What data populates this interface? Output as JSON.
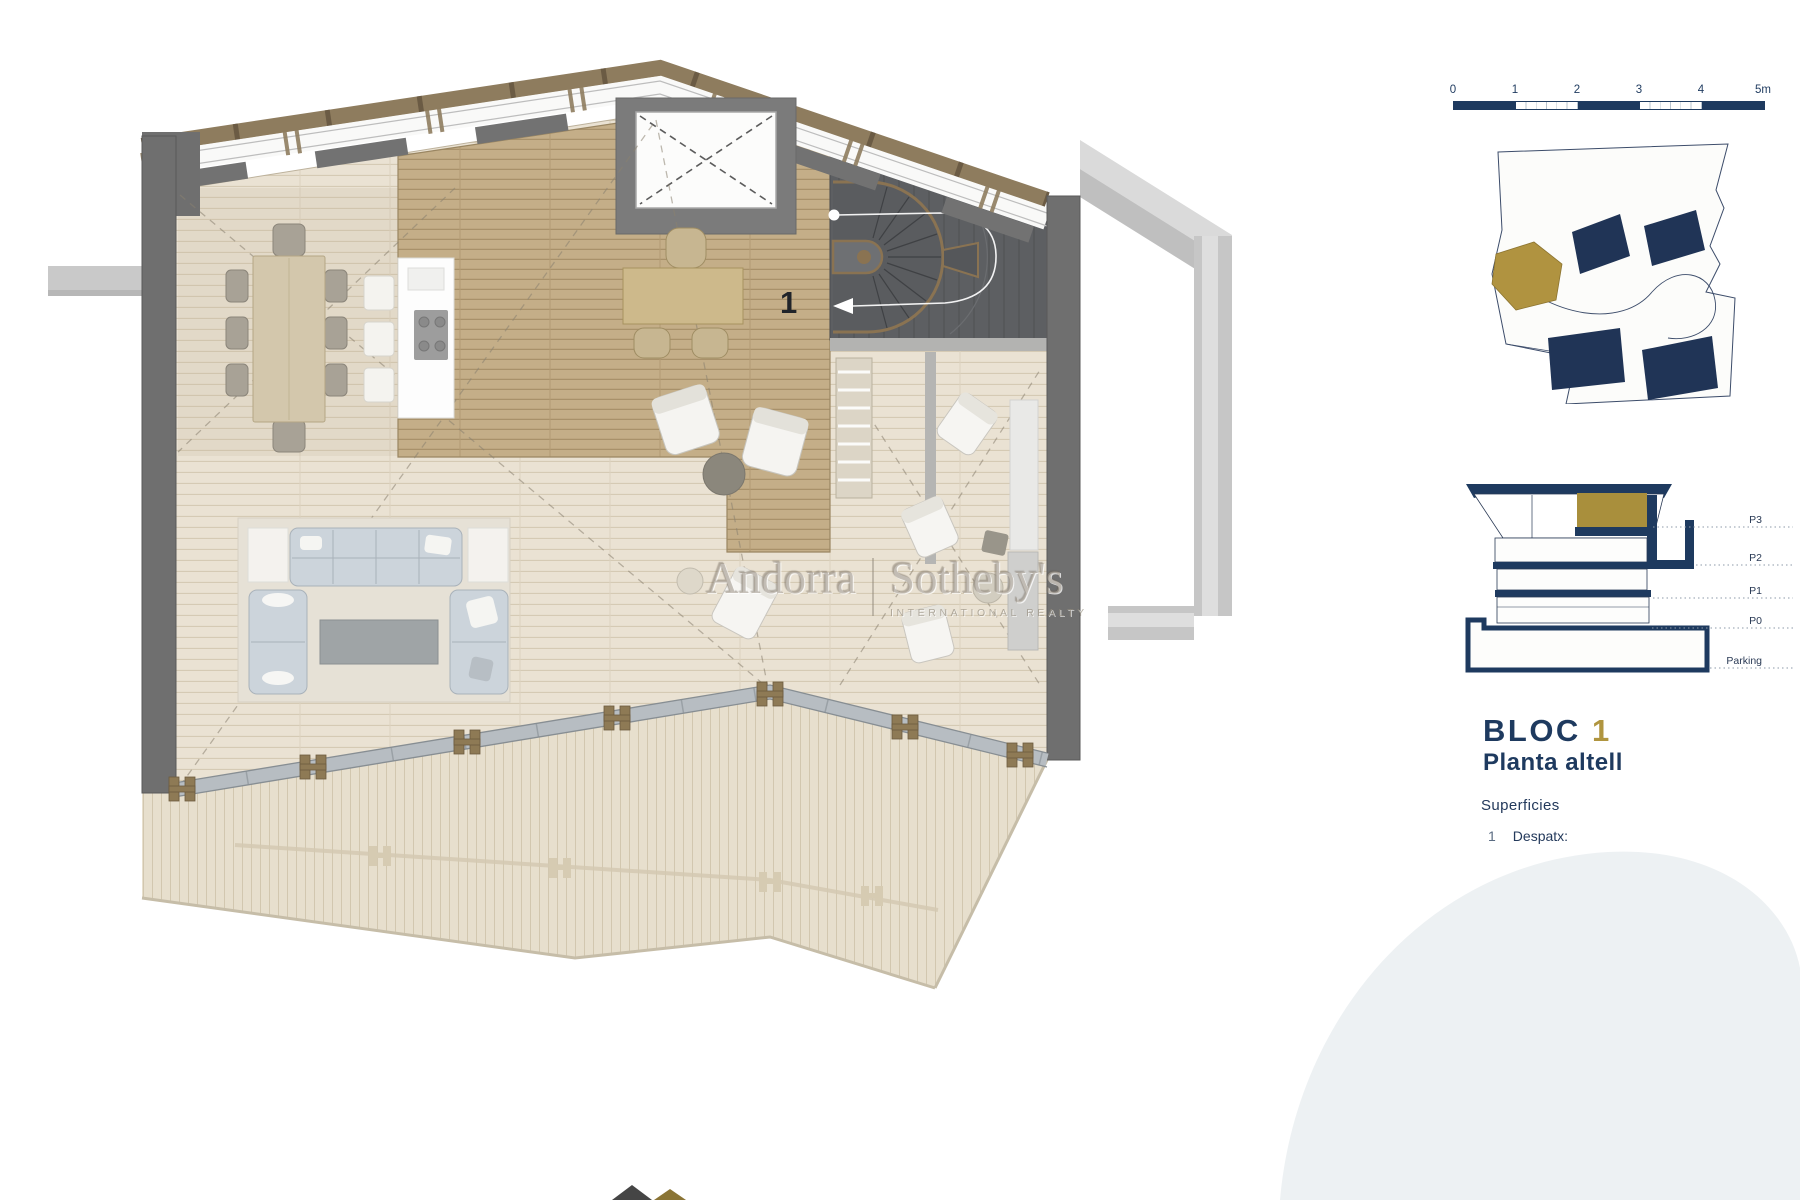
{
  "plan": {
    "room_label": "1"
  },
  "watermark": {
    "left": "Andorra",
    "right": "Sotheby's",
    "sub": "INTERNATIONAL REALTY"
  },
  "scale_bar": {
    "labels": [
      "0",
      "1",
      "2",
      "3",
      "4",
      "5m"
    ]
  },
  "section": {
    "floors": [
      "P3",
      "P2",
      "P1",
      "P0",
      "Parking"
    ]
  },
  "title": {
    "block": "BLOC",
    "number": "1",
    "subtitle": "Planta altell"
  },
  "legend": {
    "heading": "Superficies",
    "item_number": "1",
    "item_label": "Despatx:"
  },
  "colors": {
    "navy": "#1e3a5f",
    "gold": "#b0953f",
    "wall_gray": "#6f6f6f",
    "wood_dark": "#c4ae88",
    "wood_light": "#eae2d3"
  }
}
